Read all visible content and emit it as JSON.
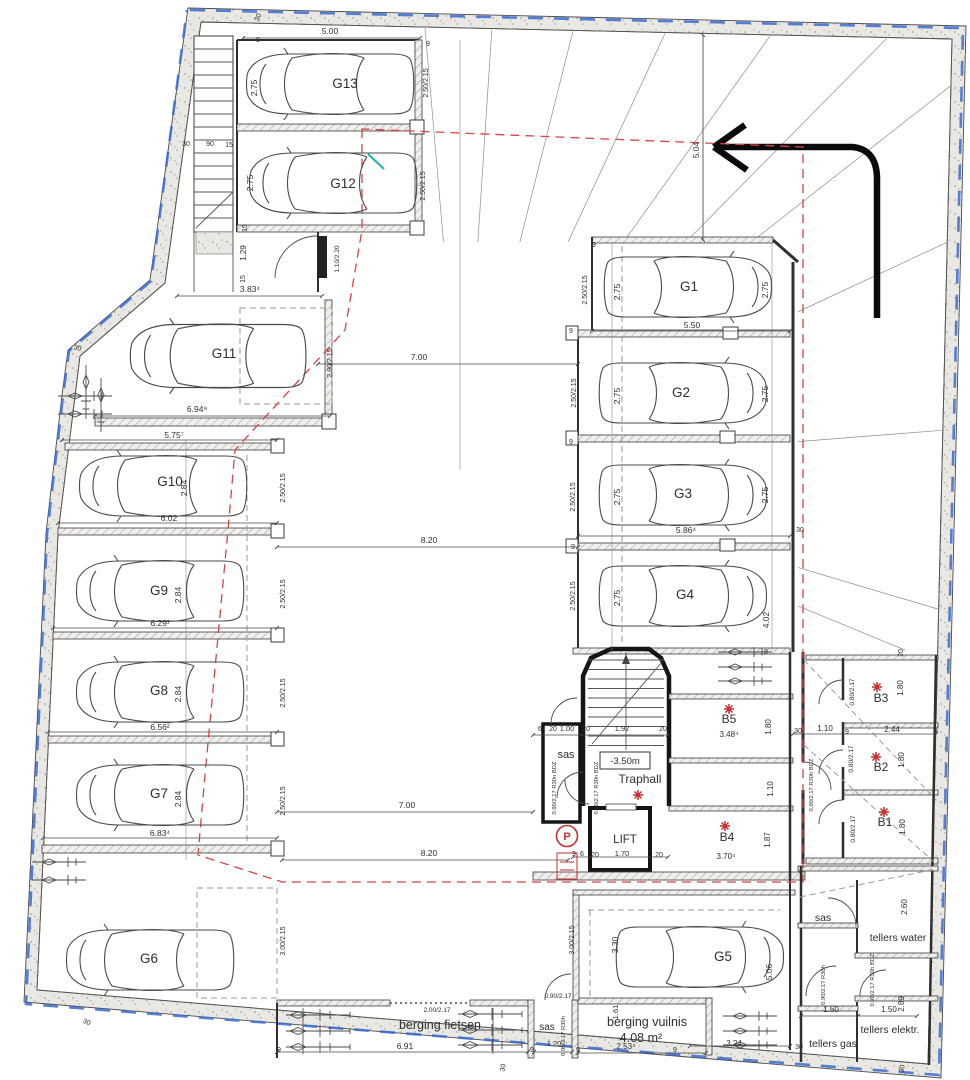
{
  "colors": {
    "red": "#c62f2f",
    "red_dash": "#d84343",
    "blue": "#3a6bd0",
    "teal": "#2ab5ae",
    "ink": "#2e2e2e"
  },
  "labels": [
    {
      "id": "spot-g13",
      "t": "G13",
      "x": 345,
      "y": 88,
      "s": 13.5
    },
    {
      "id": "spot-g12",
      "t": "G12",
      "x": 343,
      "y": 188,
      "s": 13.5
    },
    {
      "id": "spot-g11",
      "t": "G11",
      "x": 224,
      "y": 358,
      "s": 13.5
    },
    {
      "id": "spot-g10",
      "t": "G10",
      "x": 170,
      "y": 486,
      "s": 13.5
    },
    {
      "id": "spot-g9",
      "t": "G9",
      "x": 159,
      "y": 595,
      "s": 13.5
    },
    {
      "id": "spot-g8",
      "t": "G8",
      "x": 159,
      "y": 695,
      "s": 13.5
    },
    {
      "id": "spot-g7",
      "t": "G7",
      "x": 159,
      "y": 798,
      "s": 13.5
    },
    {
      "id": "spot-g6",
      "t": "G6",
      "x": 149,
      "y": 963,
      "s": 13.5
    },
    {
      "id": "spot-g1",
      "t": "G1",
      "x": 689,
      "y": 291,
      "s": 13.5
    },
    {
      "id": "spot-g2",
      "t": "G2",
      "x": 681,
      "y": 397,
      "s": 13.5
    },
    {
      "id": "spot-g3",
      "t": "G3",
      "x": 683,
      "y": 498,
      "s": 13.5
    },
    {
      "id": "spot-g4",
      "t": "G4",
      "x": 685,
      "y": 599,
      "s": 13.5
    },
    {
      "id": "spot-g5",
      "t": "G5",
      "x": 723,
      "y": 961,
      "s": 13.5
    },
    {
      "id": "room-traphall",
      "t": "Traphall",
      "x": 640,
      "y": 783,
      "s": 12
    },
    {
      "id": "room-sas-central",
      "t": "sas",
      "x": 566,
      "y": 758,
      "s": 11
    },
    {
      "id": "room-lift",
      "t": "LIFT",
      "x": 625,
      "y": 843,
      "s": 11.5
    },
    {
      "id": "room-b5",
      "t": "B5",
      "x": 729,
      "y": 723,
      "s": 12
    },
    {
      "id": "room-b4",
      "t": "B4",
      "x": 727,
      "y": 841,
      "s": 12
    },
    {
      "id": "room-b3",
      "t": "B3",
      "x": 881,
      "y": 702,
      "s": 12
    },
    {
      "id": "room-b2",
      "t": "B2",
      "x": 881,
      "y": 771,
      "s": 12
    },
    {
      "id": "room-b1",
      "t": "B1",
      "x": 885,
      "y": 826,
      "s": 12
    },
    {
      "id": "room-fietsen",
      "t": "berging fietsen",
      "x": 440,
      "y": 1029,
      "s": 12.5
    },
    {
      "id": "room-vuilnis",
      "t": "berging vuilnis",
      "x": 647,
      "y": 1026,
      "s": 12.5
    },
    {
      "id": "room-vuilnis-area",
      "t": "4.08 m²",
      "x": 641,
      "y": 1042,
      "s": 12.5
    },
    {
      "id": "room-sas-bottom",
      "t": "sas",
      "x": 547,
      "y": 1030,
      "s": 10
    },
    {
      "id": "room-sas-right",
      "t": "sas",
      "x": 823,
      "y": 921,
      "s": 10.5
    },
    {
      "id": "room-tellers-water",
      "t": "tellers water",
      "x": 898,
      "y": 941,
      "s": 10.5
    },
    {
      "id": "room-tellers-elektr",
      "t": "tellers elektr.",
      "x": 890,
      "y": 1033,
      "s": 10.5
    },
    {
      "id": "room-tellers-gas",
      "t": "tellers gas",
      "x": 833,
      "y": 1047,
      "s": 10.5
    },
    {
      "id": "level-marker",
      "t": "-3.50m",
      "x": 625,
      "y": 764,
      "s": 9.5
    },
    {
      "id": "parking-sign",
      "t": "P",
      "x": 567,
      "y": 840,
      "s": 11,
      "c": "red",
      "b": 1
    },
    {
      "id": "dim-500",
      "t": "5.00",
      "x": 330,
      "y": 34
    },
    {
      "id": "dim-383",
      "t": "3.83⁴",
      "x": 250,
      "y": 292
    },
    {
      "id": "dim-694",
      "t": "6.94⁹",
      "x": 197,
      "y": 412
    },
    {
      "id": "dim-575",
      "t": "5.75⁷",
      "x": 174,
      "y": 438
    },
    {
      "id": "dim-602",
      "t": "6.02",
      "x": 169,
      "y": 521
    },
    {
      "id": "dim-629",
      "t": "6.29¹",
      "x": 160,
      "y": 626
    },
    {
      "id": "dim-656",
      "t": "6.56²",
      "x": 160,
      "y": 730
    },
    {
      "id": "dim-683",
      "t": "6.83⁴",
      "x": 160,
      "y": 836
    },
    {
      "id": "dim-550",
      "t": "5.50",
      "x": 692,
      "y": 328
    },
    {
      "id": "dim-586",
      "t": "5.86⁴",
      "x": 686,
      "y": 533
    },
    {
      "id": "dim-700a",
      "t": "7.00",
      "x": 419,
      "y": 360
    },
    {
      "id": "dim-820a",
      "t": "8.20",
      "x": 429,
      "y": 543
    },
    {
      "id": "dim-700b",
      "t": "7.00",
      "x": 407,
      "y": 808
    },
    {
      "id": "dim-820b",
      "t": "8.20",
      "x": 429,
      "y": 856
    },
    {
      "id": "dim-348",
      "t": "3.48⁴",
      "x": 729,
      "y": 737,
      "s": 8
    },
    {
      "id": "dim-370",
      "t": "3.70⁴",
      "x": 726,
      "y": 859,
      "s": 8
    },
    {
      "id": "dim-244",
      "t": "2.44",
      "x": 892,
      "y": 732,
      "s": 8
    },
    {
      "id": "dim-110b",
      "t": "1.10",
      "x": 825,
      "y": 731,
      "s": 8
    },
    {
      "id": "dim-150a",
      "t": "1.50",
      "x": 831,
      "y": 1012,
      "s": 8
    },
    {
      "id": "dim-150b",
      "t": "1.50",
      "x": 889,
      "y": 1012,
      "s": 8
    },
    {
      "id": "dim-691",
      "t": "6.91",
      "x": 405,
      "y": 1049
    },
    {
      "id": "dim-253",
      "t": "2.53⁴",
      "x": 626,
      "y": 1049,
      "s": 8
    },
    {
      "id": "dim-324",
      "t": "3.24",
      "x": 734,
      "y": 1046,
      "s": 8
    },
    {
      "id": "dim-120",
      "t": "1.20",
      "x": 554,
      "y": 1046,
      "s": 7.5
    },
    {
      "id": "dim-100",
      "t": "1.00",
      "x": 567,
      "y": 731,
      "s": 7.5
    },
    {
      "id": "dim-192",
      "t": "1.92",
      "x": 622,
      "y": 731,
      "s": 7.5
    },
    {
      "id": "dim-170",
      "t": "1.70",
      "x": 622,
      "y": 856,
      "s": 7.5
    },
    {
      "id": "door-90217",
      "t": "0.90/2.17",
      "x": 558,
      "y": 998,
      "s": 6.5
    },
    {
      "id": "door-200217",
      "t": "2.00/2.17",
      "x": 437,
      "y": 1012,
      "s": 6.5
    },
    {
      "id": "dim-275a",
      "t": "2.75",
      "x": 257,
      "y": 88,
      "r": -90
    },
    {
      "id": "dim-275b",
      "t": "2.75",
      "x": 253,
      "y": 183,
      "r": -90
    },
    {
      "id": "dim-2502a",
      "t": "2.50/2.15",
      "x": 428,
      "y": 83,
      "r": -90,
      "s": 7
    },
    {
      "id": "dim-2502b",
      "t": "2.50/2.15",
      "x": 425,
      "y": 186,
      "r": -90,
      "s": 7
    },
    {
      "id": "dim-2802",
      "t": "2.80/2.15",
      "x": 332,
      "y": 363,
      "r": -90,
      "s": 7
    },
    {
      "id": "dim-284a",
      "t": "2.84",
      "x": 187,
      "y": 488,
      "r": -90
    },
    {
      "id": "dim-2502c",
      "t": "2.50/2.15",
      "x": 285,
      "y": 488,
      "r": -90,
      "s": 7
    },
    {
      "id": "dim-284b",
      "t": "2.84",
      "x": 181,
      "y": 595,
      "r": -90
    },
    {
      "id": "dim-2502d",
      "t": "2.50/2.15",
      "x": 285,
      "y": 594,
      "r": -90,
      "s": 7
    },
    {
      "id": "dim-284c",
      "t": "2.84",
      "x": 181,
      "y": 694,
      "r": -90
    },
    {
      "id": "dim-2502e",
      "t": "2.50/2.15",
      "x": 285,
      "y": 693,
      "r": -90,
      "s": 7
    },
    {
      "id": "dim-284d",
      "t": "2.84",
      "x": 181,
      "y": 799,
      "r": -90
    },
    {
      "id": "dim-2502f",
      "t": "2.50/2.15",
      "x": 285,
      "y": 801,
      "r": -90,
      "s": 7
    },
    {
      "id": "dim-3002a",
      "t": "3.00/2.15",
      "x": 285,
      "y": 941,
      "r": -90,
      "s": 7
    },
    {
      "id": "dim-504",
      "t": "5.04",
      "x": 699,
      "y": 150,
      "r": -90
    },
    {
      "id": "dim-275c",
      "t": "2.75",
      "x": 620,
      "y": 292,
      "r": -90
    },
    {
      "id": "dim-275d",
      "t": "2.75",
      "x": 768,
      "y": 290,
      "r": -90
    },
    {
      "id": "dim-2502g",
      "t": "2.50/2.15",
      "x": 587,
      "y": 290,
      "r": -90,
      "s": 7
    },
    {
      "id": "dim-275e",
      "t": "2.75",
      "x": 620,
      "y": 396,
      "r": -90
    },
    {
      "id": "dim-275f",
      "t": "2.75",
      "x": 768,
      "y": 394,
      "r": -90
    },
    {
      "id": "dim-2502h",
      "t": "2.50/2.15",
      "x": 576,
      "y": 393,
      "r": -90,
      "s": 7
    },
    {
      "id": "dim-275g",
      "t": "2.75",
      "x": 620,
      "y": 497,
      "r": -90
    },
    {
      "id": "dim-275h",
      "t": "2.75",
      "x": 768,
      "y": 495,
      "r": -90
    },
    {
      "id": "dim-2502i",
      "t": "2.50/2.15",
      "x": 575,
      "y": 497,
      "r": -90,
      "s": 7
    },
    {
      "id": "dim-275i",
      "t": "2.75",
      "x": 620,
      "y": 598,
      "r": -90
    },
    {
      "id": "dim-402",
      "t": "4.02",
      "x": 769,
      "y": 620,
      "r": -90
    },
    {
      "id": "dim-2502j",
      "t": "2.50/2.15",
      "x": 575,
      "y": 596,
      "r": -90,
      "s": 7
    },
    {
      "id": "dim-129",
      "t": "1.29",
      "x": 246,
      "y": 253,
      "r": -90,
      "s": 8
    },
    {
      "id": "door-110220",
      "t": "1.10/2.20",
      "x": 339,
      "y": 259,
      "r": -90,
      "s": 6.5
    },
    {
      "id": "dim-180a",
      "t": "1.80",
      "x": 771,
      "y": 727,
      "r": -90,
      "s": 8
    },
    {
      "id": "dim-110a",
      "t": "1.10",
      "x": 773,
      "y": 789,
      "r": -90,
      "s": 8
    },
    {
      "id": "dim-187",
      "t": "1.87",
      "x": 770,
      "y": 840,
      "r": -90,
      "s": 8
    },
    {
      "id": "dim-180b",
      "t": "1.80",
      "x": 903,
      "y": 688,
      "r": -90,
      "s": 8
    },
    {
      "id": "dim-180c",
      "t": "1.80",
      "x": 904,
      "y": 760,
      "r": -90,
      "s": 8
    },
    {
      "id": "dim-180d",
      "t": "1.80",
      "x": 905,
      "y": 827,
      "r": -90,
      "s": 8
    },
    {
      "id": "door-80217a",
      "t": "0.80/2.17",
      "x": 854,
      "y": 692,
      "r": -90,
      "s": 6.5
    },
    {
      "id": "door-80217b",
      "t": "0.80/2.17",
      "x": 853,
      "y": 759,
      "r": -90,
      "s": 6.5
    },
    {
      "id": "door-80217c",
      "t": "0.80/2.17",
      "x": 855,
      "y": 829,
      "r": -90,
      "s": 6.5
    },
    {
      "id": "dim-330",
      "t": "3.30",
      "x": 618,
      "y": 945,
      "r": -90
    },
    {
      "id": "dim-506",
      "t": "5.06",
      "x": 772,
      "y": 972,
      "r": -90
    },
    {
      "id": "dim-3002b",
      "t": "3.00/2.15",
      "x": 574,
      "y": 940,
      "r": -90,
      "s": 7
    },
    {
      "id": "dim-161",
      "t": "1.61",
      "x": 618,
      "y": 1012,
      "r": -90,
      "s": 7.5
    },
    {
      "id": "dim-260",
      "t": "2.60",
      "x": 907,
      "y": 907,
      "r": -90,
      "s": 8
    },
    {
      "id": "dim-289",
      "t": "2.89",
      "x": 904,
      "y": 1004,
      "r": -90,
      "s": 8
    },
    {
      "id": "door-bdz-1",
      "t": "0.90/2.17 R30n BDZ",
      "x": 556,
      "y": 788,
      "r": -90,
      "s": 5.8
    },
    {
      "id": "door-bdz-2",
      "t": "0.90/2.17 R30n BDZ",
      "x": 598,
      "y": 788,
      "r": -90,
      "s": 5.8
    },
    {
      "id": "door-bdz-3",
      "t": "0.90/2.17 R30h BDZ",
      "x": 813,
      "y": 785,
      "r": -90,
      "s": 5.8
    },
    {
      "id": "door-bdz-4",
      "t": "0.90/2.17 R30h BDZ",
      "x": 874,
      "y": 980,
      "r": -90,
      "s": 5.8
    },
    {
      "id": "door-r30h-1",
      "t": "0.90/2.17 R30h",
      "x": 825,
      "y": 985,
      "r": -90,
      "s": 5.8
    },
    {
      "id": "door-r30h-2",
      "t": "0.90/2.17 R30h",
      "x": 565,
      "y": 1036,
      "r": -90,
      "s": 5.8
    },
    {
      "id": "tick-30a",
      "t": "30",
      "x": 260,
      "y": 18,
      "r": -70,
      "s": 7
    },
    {
      "id": "tick-30b",
      "t": "30",
      "x": 186,
      "y": 146,
      "s": 7
    },
    {
      "id": "tick-30c",
      "t": "30",
      "x": 77,
      "y": 350,
      "r": 15,
      "s": 7
    },
    {
      "id": "tick-30d",
      "t": "30",
      "x": 800,
      "y": 532,
      "s": 7
    },
    {
      "id": "tick-30e",
      "t": "30",
      "x": 798,
      "y": 733,
      "s": 7
    },
    {
      "id": "tick-30f",
      "t": "30",
      "x": 86,
      "y": 1024,
      "r": 20,
      "s": 7
    },
    {
      "id": "tick-30g",
      "t": "30",
      "x": 505,
      "y": 1068,
      "r": -80,
      "s": 7
    },
    {
      "id": "tick-30h",
      "t": "30",
      "x": 799,
      "y": 1049,
      "s": 7
    },
    {
      "id": "tick-30i",
      "t": "30",
      "x": 904,
      "y": 1069,
      "r": -80,
      "s": 7
    },
    {
      "id": "tick-90",
      "t": "90",
      "x": 210,
      "y": 146,
      "s": 7
    },
    {
      "id": "tick-15a",
      "t": "15",
      "x": 229,
      "y": 147,
      "s": 7
    },
    {
      "id": "tick-15b",
      "t": "15",
      "x": 247,
      "y": 228,
      "r": -90,
      "s": 7
    },
    {
      "id": "tick-15c",
      "t": "15",
      "x": 245,
      "y": 279,
      "r": -90,
      "s": 7
    },
    {
      "id": "tick-9a",
      "t": "9",
      "x": 258,
      "y": 42,
      "s": 7
    },
    {
      "id": "tick-9b",
      "t": "9",
      "x": 428,
      "y": 46,
      "s": 7
    },
    {
      "id": "tick-9c",
      "t": "9",
      "x": 594,
      "y": 247,
      "s": 7
    },
    {
      "id": "tick-9d",
      "t": "9",
      "x": 571,
      "y": 333,
      "s": 7
    },
    {
      "id": "tick-9e",
      "t": "9",
      "x": 571,
      "y": 444,
      "s": 7
    },
    {
      "id": "tick-9f",
      "t": "9",
      "x": 573,
      "y": 549,
      "s": 7
    },
    {
      "id": "tick-9g",
      "t": "9",
      "x": 766,
      "y": 654,
      "s": 7
    },
    {
      "id": "tick-9h",
      "t": "9",
      "x": 847,
      "y": 734,
      "s": 7
    },
    {
      "id": "tick-9i",
      "t": "9",
      "x": 936,
      "y": 734,
      "s": 7
    },
    {
      "id": "tick-9j",
      "t": "9",
      "x": 578,
      "y": 1052,
      "s": 7
    },
    {
      "id": "tick-9k",
      "t": "9",
      "x": 675,
      "y": 1052,
      "s": 7
    },
    {
      "id": "tick-9l",
      "t": "9",
      "x": 279,
      "y": 1052,
      "s": 7
    },
    {
      "id": "tick-9m",
      "t": "9",
      "x": 532,
      "y": 1052,
      "s": 7
    },
    {
      "id": "tick-9n",
      "t": "9",
      "x": 574,
      "y": 856,
      "s": 7
    },
    {
      "id": "tick-20a",
      "t": "20",
      "x": 553,
      "y": 731,
      "s": 7
    },
    {
      "id": "tick-20b",
      "t": "20",
      "x": 586,
      "y": 731,
      "s": 7
    },
    {
      "id": "tick-20c",
      "t": "20",
      "x": 663,
      "y": 731,
      "s": 7
    },
    {
      "id": "tick-20d",
      "t": "20",
      "x": 595,
      "y": 857,
      "s": 7
    },
    {
      "id": "tick-20e",
      "t": "20",
      "x": 659,
      "y": 857,
      "s": 7
    },
    {
      "id": "tick-20f",
      "t": "20",
      "x": 903,
      "y": 653,
      "r": -90,
      "s": 7
    },
    {
      "id": "tick-6a",
      "t": "6",
      "x": 540,
      "y": 731,
      "s": 7
    },
    {
      "id": "tick-6b",
      "t": "6",
      "x": 582,
      "y": 856,
      "s": 7
    }
  ],
  "cars": [
    {
      "x": 330,
      "y": 84,
      "r": 180
    },
    {
      "x": 333,
      "y": 183,
      "r": 180
    },
    {
      "x": 218,
      "y": 356,
      "r": 180,
      "sc": 1.05
    },
    {
      "x": 163,
      "y": 486,
      "r": 180
    },
    {
      "x": 160,
      "y": 591,
      "r": 180
    },
    {
      "x": 160,
      "y": 692,
      "r": 180
    },
    {
      "x": 160,
      "y": 795,
      "r": 180
    },
    {
      "x": 150,
      "y": 960,
      "r": 180
    },
    {
      "x": 688,
      "y": 287,
      "r": 0
    },
    {
      "x": 683,
      "y": 393,
      "r": 0
    },
    {
      "x": 683,
      "y": 495,
      "r": 0
    },
    {
      "x": 683,
      "y": 596,
      "r": 0
    },
    {
      "x": 700,
      "y": 957,
      "r": 0
    }
  ],
  "bikes": [
    {
      "x": 286,
      "y": 1015
    },
    {
      "x": 286,
      "y": 1031
    },
    {
      "x": 286,
      "y": 1047
    },
    {
      "x": 458,
      "y": 1014
    },
    {
      "x": 458,
      "y": 1030
    },
    {
      "x": 458,
      "y": 1045
    }
  ],
  "drains": [
    {
      "x": 718,
      "y": 652,
      "r": 0
    },
    {
      "x": 718,
      "y": 667,
      "r": 0
    },
    {
      "x": 718,
      "y": 681,
      "r": 0
    },
    {
      "x": 723,
      "y": 1016,
      "r": 0
    },
    {
      "x": 723,
      "y": 1031,
      "r": 0
    },
    {
      "x": 723,
      "y": 1045,
      "r": 0
    },
    {
      "x": 86,
      "y": 365,
      "r": 90
    },
    {
      "x": 101,
      "y": 378,
      "r": 90
    },
    {
      "x": 58,
      "y": 396,
      "r": 0
    },
    {
      "x": 58,
      "y": 414,
      "r": 0
    },
    {
      "x": 32,
      "y": 862,
      "r": 0
    },
    {
      "x": 32,
      "y": 880,
      "r": 0
    }
  ],
  "asterisks": [
    {
      "x": 638,
      "y": 795
    },
    {
      "x": 729,
      "y": 709
    },
    {
      "x": 725,
      "y": 826
    },
    {
      "x": 877,
      "y": 687
    },
    {
      "x": 876,
      "y": 757
    },
    {
      "x": 884,
      "y": 812
    }
  ]
}
